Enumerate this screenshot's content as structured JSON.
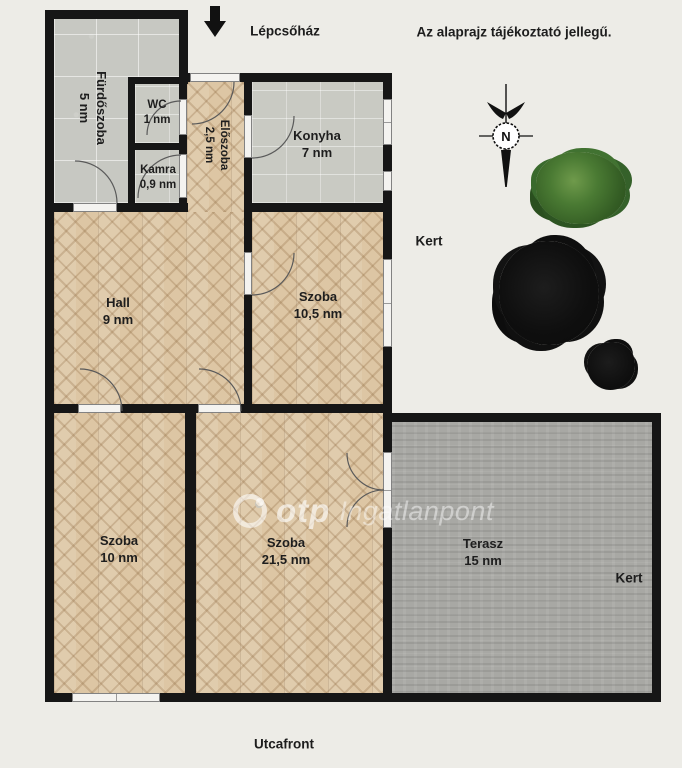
{
  "header": {
    "staircase_label": "Lépcsőház",
    "disclaimer": "Az alaprajz tájékoztató jellegű."
  },
  "rooms": {
    "furdoszoba": {
      "label": "Fürdőszoba",
      "area": "5 nm"
    },
    "wc": {
      "label": "WC",
      "area": "1 nm"
    },
    "kamra": {
      "label": "Kamra",
      "area": "0,9 nm"
    },
    "eloszoba": {
      "label": "Előszoba",
      "area": "2,5 nm"
    },
    "konyha": {
      "label": "Konyha",
      "area": "7 nm"
    },
    "hall": {
      "label": "Hall",
      "area": "9 nm"
    },
    "szoba_105": {
      "label": "Szoba",
      "area": "10,5 nm"
    },
    "szoba_10": {
      "label": "Szoba",
      "area": "10 nm"
    },
    "szoba_215": {
      "label": "Szoba",
      "area": "21,5 nm"
    },
    "terasz": {
      "label": "Terasz",
      "area": "15 nm"
    }
  },
  "outdoor": {
    "garden_upper": "Kert",
    "garden_lower": "Kert",
    "street_front": "Utcafront"
  },
  "compass": {
    "north": "N"
  },
  "watermark": {
    "brand": "otp",
    "name": "Ingatlanpont"
  },
  "colors": {
    "background": "#edece7",
    "wall": "#161616",
    "wood_floor": "#ddc6a4",
    "tile_floor": "#c9cac3",
    "terrace_floor": "#a8a8a4",
    "tree_green": "#3f6b2a",
    "tree_dark": "#121212"
  }
}
